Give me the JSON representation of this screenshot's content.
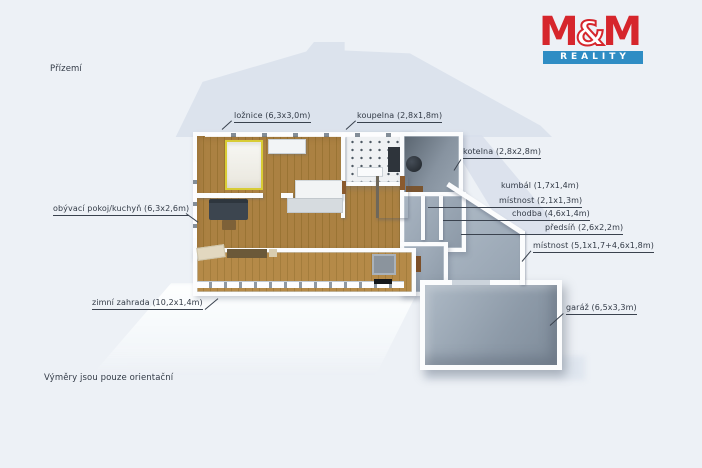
{
  "page": {
    "floor_title": "Přízemí",
    "footnote": "Výměry jsou pouze orientační"
  },
  "logo": {
    "m1": "M",
    "amp": "&",
    "m2": "M",
    "reality": "REALITY",
    "red": "#d6262c",
    "blue": "#2f8dc4"
  },
  "room_labels": [
    {
      "id": "loznice",
      "name": "ložnice",
      "dims": "6,3x3,0m",
      "text": "ložnice (6,3x3,0m)"
    },
    {
      "id": "koupelna",
      "name": "koupelna",
      "dims": "2,8x1,8m",
      "text": "koupelna (2,8x1,8m)"
    },
    {
      "id": "kotelna",
      "name": "kotelna",
      "dims": "2,8x2,8m",
      "text": "kotelna (2,8x2,8m)"
    },
    {
      "id": "kumbal",
      "name": "kumbál",
      "dims": "1,7x1,4m",
      "text": "kumbál (1,7x1,4m)"
    },
    {
      "id": "mistnost_a",
      "name": "místnost",
      "dims": "2,1x1,3m",
      "text": "místnost (2,1x1,3m)"
    },
    {
      "id": "chodba",
      "name": "chodba",
      "dims": "4,6x1,4m",
      "text": "chodba (4,6x1,4m)"
    },
    {
      "id": "predsin",
      "name": "předsíň",
      "dims": "2,6x2,2m",
      "text": "předsíň (2,6x2,2m)"
    },
    {
      "id": "mistnost_b",
      "name": "místnost",
      "dims": "5,1x1,7+4,6x1,8m",
      "text": "místnost (5,1x1,7+4,6x1,8m)"
    },
    {
      "id": "obyvaci",
      "name": "obývací pokoj/kuchyň",
      "dims": "6,3x2,6m",
      "text": "obývací pokoj/kuchyň (6,3x2,6m)"
    },
    {
      "id": "zimni",
      "name": "zimní zahrada",
      "dims": "10,2x1,4m",
      "text": "zimní zahrada (10,2x1,4m)"
    },
    {
      "id": "garaz",
      "name": "garáž",
      "dims": "6,5x3,3m",
      "text": "garáž (6,5x3,3m)"
    }
  ],
  "colors": {
    "background": "#edf1f6",
    "wall": "#fbfcfd",
    "wood_floor": "#ab8142",
    "concrete_floor": "#8e9aa8",
    "bed_frame_yellow": "#d8cc35",
    "ground_shadow": "#dce3ed",
    "label_text": "#323a46"
  }
}
